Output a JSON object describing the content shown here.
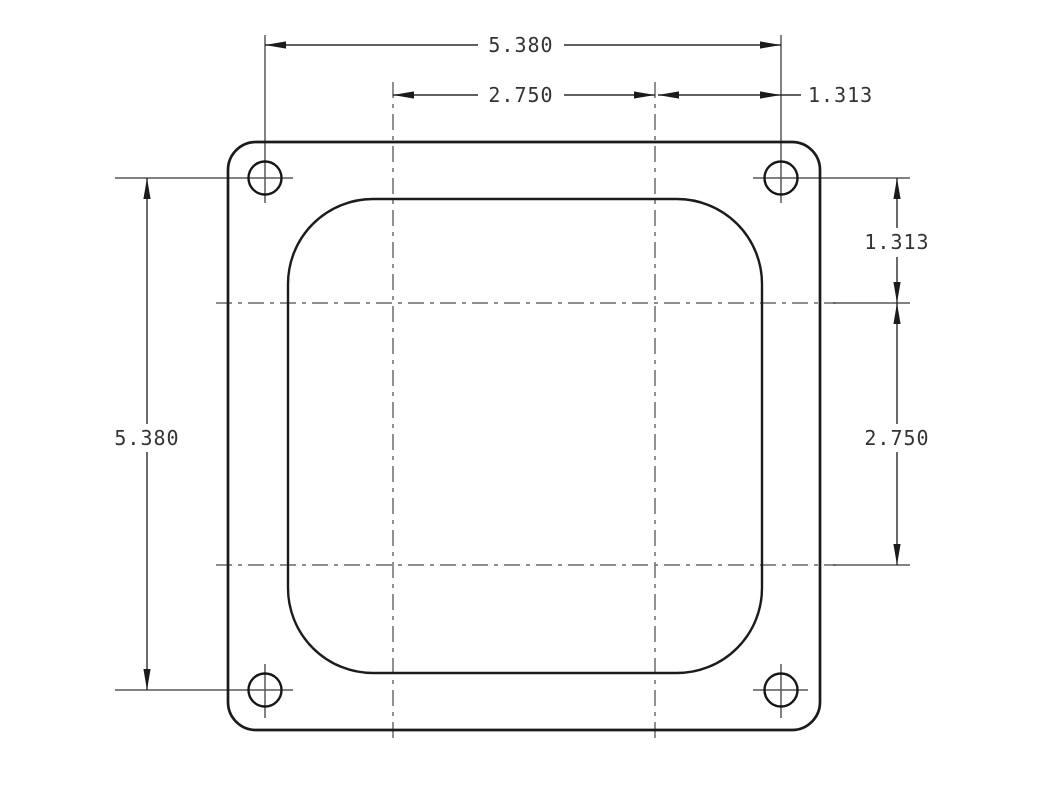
{
  "drawing": {
    "type": "technical-dimension-drawing",
    "view": "square-flange plate with rounded-square bore and four bolt holes",
    "dimensions": {
      "top_overall": "5.380",
      "top_bore_span": "2.750",
      "top_hole_offset": "1.313",
      "left_overall": "5.380",
      "right_upper_offset": "1.313",
      "right_bore_span": "2.750"
    },
    "colors": {
      "outline": "#1b1b1b",
      "dimension_line": "#2b2b2b",
      "extension_line": "#585858",
      "centerline": "#7d7d7d",
      "text": "#333333",
      "background": "#ffffff"
    }
  }
}
